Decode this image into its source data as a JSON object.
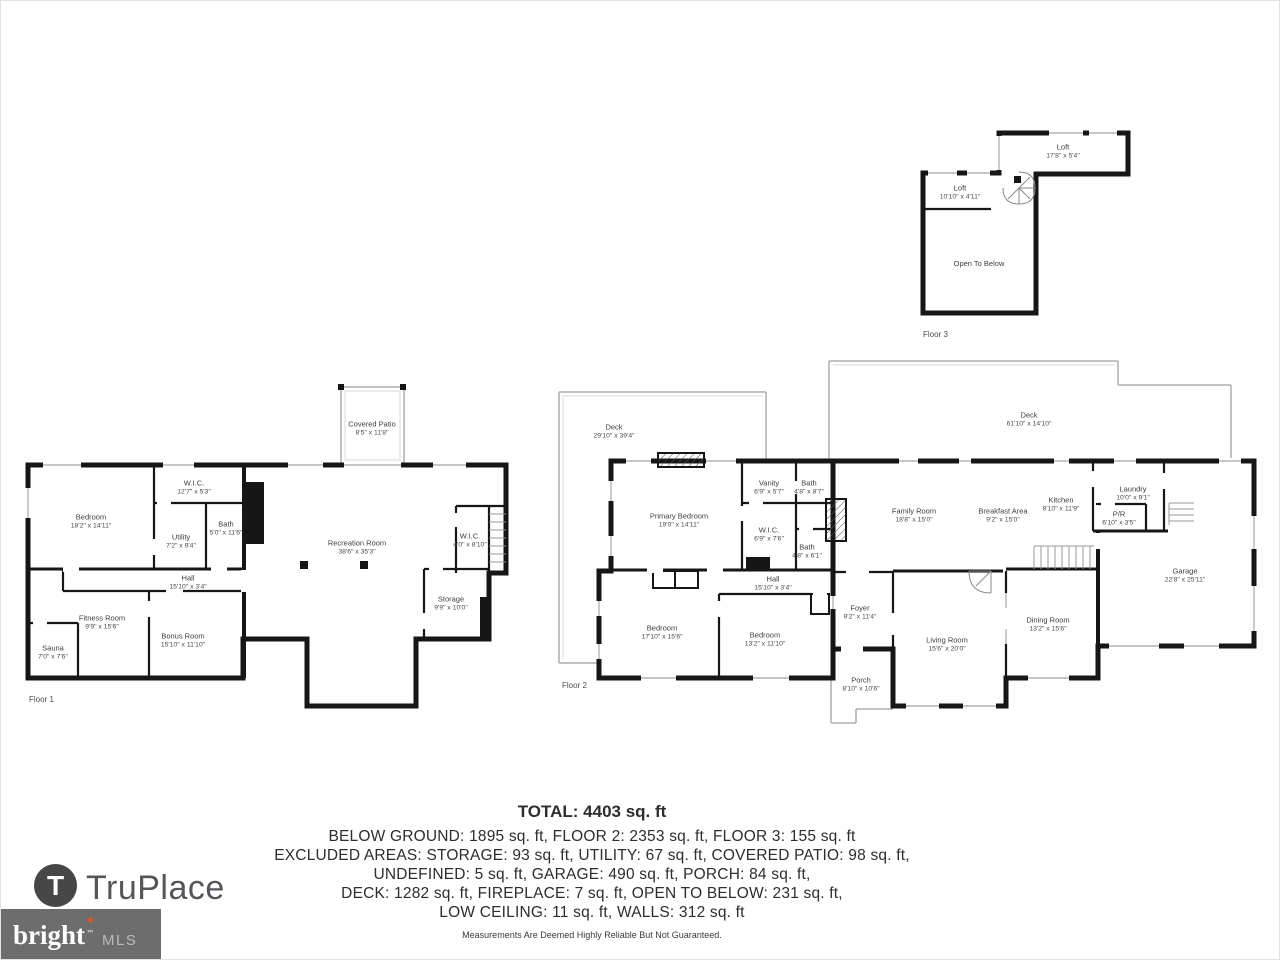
{
  "colors": {
    "wall": "#161616",
    "window": "#b3b3b3",
    "accent_orange": "#e0562a",
    "logo_gray": "#55565a",
    "bright_box": "#6d6d6d"
  },
  "floors": {
    "floor1": {
      "caption": "Floor 1",
      "rooms": [
        {
          "name": "Bedroom",
          "dims": "18'2\" x 14'11\""
        },
        {
          "name": "W.I.C.",
          "dims": "12'7\" x 5'3\""
        },
        {
          "name": "Utility",
          "dims": "7'2\" x 9'4\""
        },
        {
          "name": "Bath",
          "dims": "5'0\" x 11'6\""
        },
        {
          "name": "Hall",
          "dims": "15'10\" x 3'4\""
        },
        {
          "name": "Fitness Room",
          "dims": "9'9\" x 15'6\""
        },
        {
          "name": "Sauna",
          "dims": "7'0\" x 7'6\""
        },
        {
          "name": "Bonus Room",
          "dims": "15'10\" x 11'10\""
        },
        {
          "name": "Covered Patio",
          "dims": "8'5\" x 11'8\""
        },
        {
          "name": "Recreation Room",
          "dims": "38'6\" x 35'3\""
        },
        {
          "name": "W.I.C.",
          "dims": "4'0\" x 8'10\""
        },
        {
          "name": "Storage",
          "dims": "9'9\" x 10'0\""
        }
      ]
    },
    "floor2": {
      "caption": "Floor 2",
      "rooms": [
        {
          "name": "Deck",
          "dims": "29'10\" x 39'4\""
        },
        {
          "name": "Primary Bedroom",
          "dims": "19'0\" x 14'11\""
        },
        {
          "name": "Vanity",
          "dims": "6'9\" x 5'7\""
        },
        {
          "name": "Bath",
          "dims": "4'8\" x 8'7\""
        },
        {
          "name": "W.I.C.",
          "dims": "6'9\" x 7'6\""
        },
        {
          "name": "Bath",
          "dims": "4'8\" x 6'1\""
        },
        {
          "name": "Hall",
          "dims": "15'10\" x 3'4\""
        },
        {
          "name": "Bedroom",
          "dims": "17'10\" x 15'6\""
        },
        {
          "name": "Bedroom",
          "dims": "13'2\" x 11'10\""
        },
        {
          "name": "Deck",
          "dims": "61'10\" x 14'10\""
        },
        {
          "name": "Family Room",
          "dims": "18'8\" x 15'0\""
        },
        {
          "name": "Breakfast Area",
          "dims": "9'2\" x 15'0\""
        },
        {
          "name": "Kitchen",
          "dims": "8'10\" x 11'9\""
        },
        {
          "name": "Laundry",
          "dims": "10'0\" x 9'1\""
        },
        {
          "name": "P/R",
          "dims": "6'10\" x 3'5\""
        },
        {
          "name": "Garage",
          "dims": "22'8\" x 25'11\""
        },
        {
          "name": "Foyer",
          "dims": "9'2\" x 11'4\""
        },
        {
          "name": "Living Room",
          "dims": "15'6\" x 20'0\""
        },
        {
          "name": "Dining Room",
          "dims": "13'2\" x 15'6\""
        },
        {
          "name": "Porch",
          "dims": "8'10\" x 10'6\""
        }
      ]
    },
    "floor3": {
      "caption": "Floor 3",
      "rooms": [
        {
          "name": "Loft",
          "dims": "17'8\" x 5'4\""
        },
        {
          "name": "Loft",
          "dims": "10'10\" x 4'11\""
        },
        {
          "name": "Open To Below",
          "dims": ""
        }
      ]
    }
  },
  "totals": {
    "title": "TOTAL: 4403 sq. ft",
    "lines": [
      "BELOW GROUND: 1895 sq. ft, FLOOR 2: 2353 sq. ft, FLOOR 3: 155 sq. ft",
      "EXCLUDED AREAS: STORAGE: 93 sq. ft, UTILITY: 67 sq. ft, COVERED PATIO: 98 sq. ft,",
      "UNDEFINED: 5 sq. ft, GARAGE: 490 sq. ft, PORCH: 84 sq. ft,",
      "DECK: 1282 sq. ft, FIREPLACE: 7 sq. ft, OPEN TO BELOW: 231 sq. ft,",
      "LOW CEILING: 11 sq. ft, WALLS: 312 sq. ft"
    ],
    "disclaimer": "Measurements Are Deemed Highly Reliable But Not Guaranteed."
  },
  "footer": {
    "truplace_initial": "T",
    "truplace_name": "TruPlace",
    "bright": "bright",
    "bright_tm": "™",
    "mls": "MLS"
  }
}
